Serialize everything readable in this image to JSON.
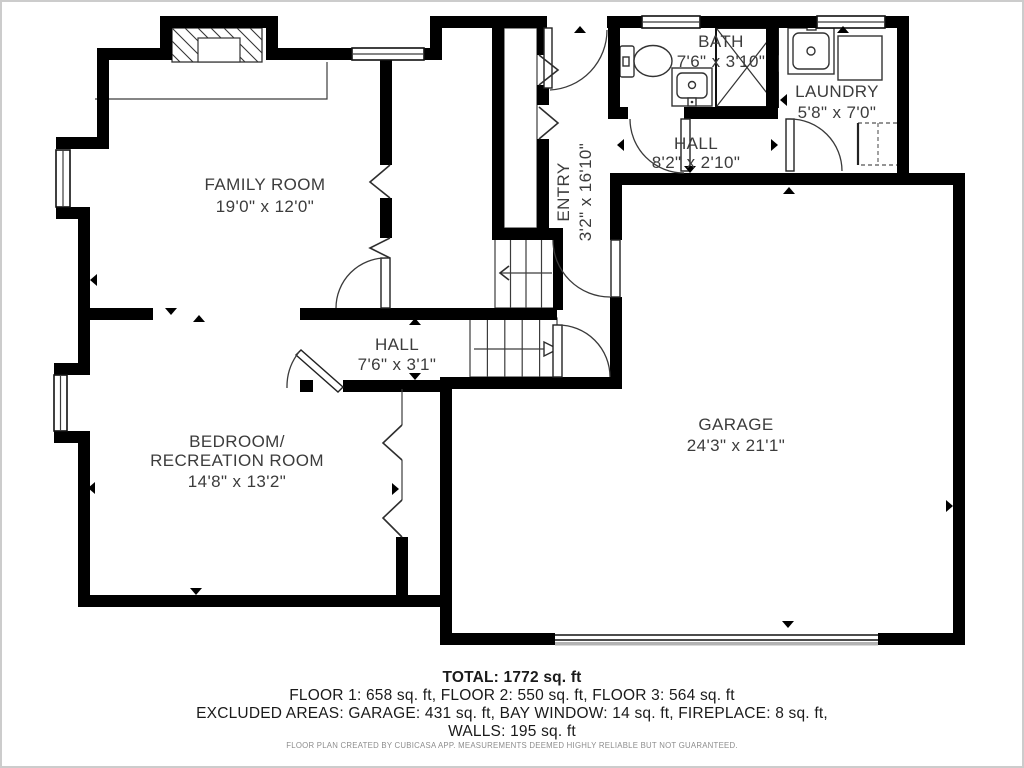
{
  "rooms": {
    "family_room": {
      "name": "FAMILY ROOM",
      "dims": "19'0\" x 12'0\""
    },
    "entry": {
      "name": "ENTRY",
      "dims": "3'2\" x 16'10\""
    },
    "bath": {
      "name": "BATH",
      "dims": "7'6\" x 3'10\""
    },
    "hall_upper": {
      "name": "HALL",
      "dims": "8'2\" x 2'10\""
    },
    "laundry": {
      "name": "LAUNDRY",
      "dims": "5'8\" x 7'0\""
    },
    "hall_lower": {
      "name": "HALL",
      "dims": "7'6\" x 3'1\""
    },
    "bedroom": {
      "name": "BEDROOM/",
      "name2": "RECREATION ROOM",
      "dims": "14'8\" x 13'2\""
    },
    "garage": {
      "name": "GARAGE",
      "dims": "24'3\" x 21'1\""
    }
  },
  "summary": {
    "total": "TOTAL: 1772 sq. ft",
    "floors": "FLOOR 1: 658 sq. ft, FLOOR 2: 550 sq. ft, FLOOR 3: 564 sq. ft",
    "excluded_line1": "EXCLUDED AREAS: GARAGE: 431 sq. ft, BAY WINDOW: 14 sq. ft, FIREPLACE: 8 sq. ft,",
    "excluded_line2": "WALLS: 195 sq. ft",
    "disclaimer": "FLOOR PLAN CREATED BY CUBICASA APP. MEASUREMENTS DEEMED HIGHLY RELIABLE BUT NOT GUARANTEED."
  },
  "colors": {
    "wall": "#000000",
    "label_text": "#3c3c3c",
    "summary_text": "#1a1a1a",
    "frame": "#cccccc"
  }
}
